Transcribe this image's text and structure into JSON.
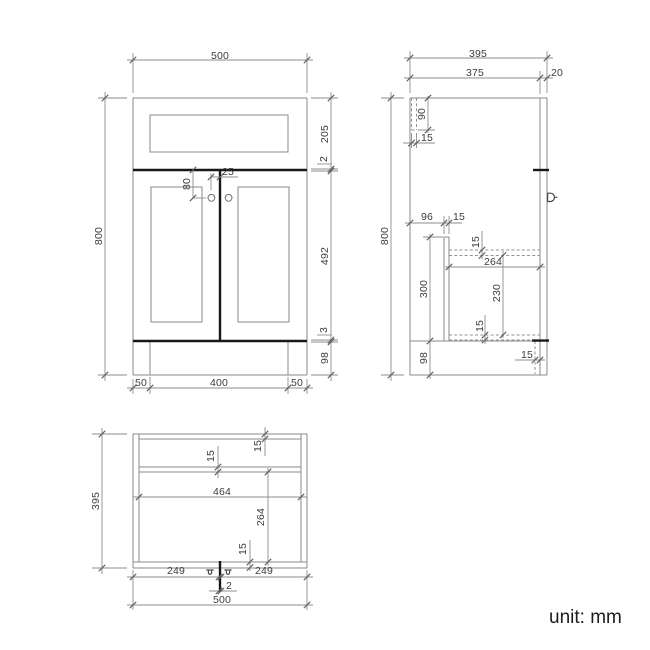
{
  "unit_label": "unit: mm",
  "front_view": {
    "overall_width": "500",
    "overall_height": "800",
    "drawer_front_height": "205",
    "drawer_door_gap": "2",
    "door_height": "492",
    "door_bottom_gap": "3",
    "plinth_height": "98",
    "plinth_inset_left": "50",
    "plinth_width": "400",
    "plinth_inset_right": "50",
    "knob_drop_from_door_top": "80",
    "knob_offset_from_centre": "25"
  },
  "side_view": {
    "overall_depth": "395",
    "carcass_depth": "375",
    "door_thickness": "20",
    "overall_height": "800",
    "back_rail_height": "90",
    "back_rail_thickness": "15",
    "partition_setback": "96",
    "partition_thickness": "15",
    "shelf_thickness": "15",
    "shelf_depth": "264",
    "partition_height": "300",
    "shelf_clearance": "230",
    "bottom_shelf_thickness": "15",
    "plinth_height": "98",
    "plinth_recess": "15"
  },
  "plan_view": {
    "overall_depth": "395",
    "mid_rail_thickness": "15",
    "back_rail_thickness": "15",
    "inner_width": "464",
    "inner_depth": "264",
    "front_rail_thickness": "15",
    "left_door_width": "249",
    "door_gap": "2",
    "right_door_width": "249",
    "overall_width": "500"
  }
}
